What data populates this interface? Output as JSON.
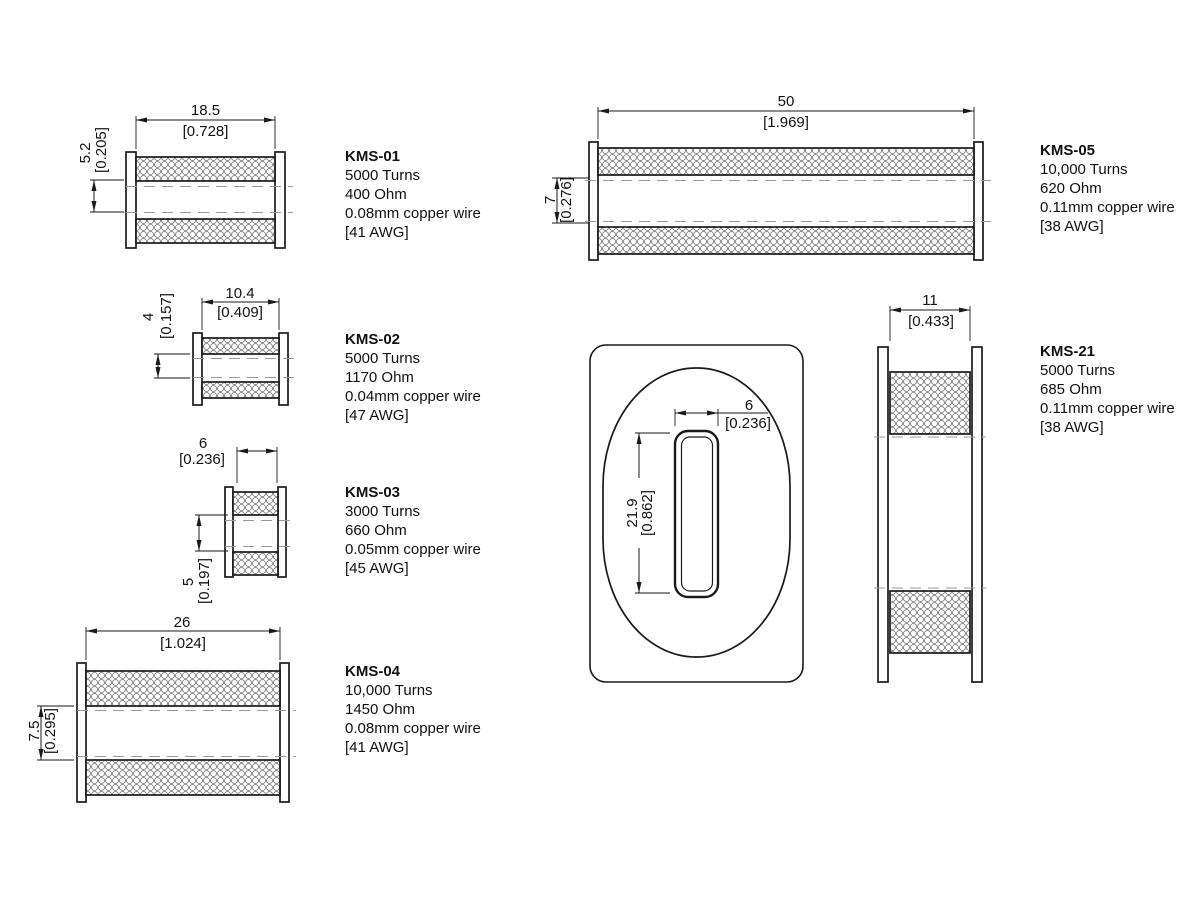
{
  "sheet": {
    "background": "#ffffff",
    "line_color": "#1a1a1a",
    "dashed_color": "#999999",
    "hatch_name": "coil-winding-hatch"
  },
  "products": [
    {
      "id": "KMS-01",
      "turns": "5000 Turns",
      "ohm": "400 Ohm",
      "wire": "0.08mm copper wire",
      "awg": "[41 AWG]",
      "width_mm": "18.5",
      "width_in": "[0.728]",
      "height_mm": "5.2",
      "height_in": "[0.205]"
    },
    {
      "id": "KMS-02",
      "turns": "5000 Turns",
      "ohm": "1170 Ohm",
      "wire": "0.04mm copper wire",
      "awg": "[47 AWG]",
      "width_mm": "10.4",
      "width_in": "[0.409]",
      "height_mm": "4",
      "height_in": "[0.157]"
    },
    {
      "id": "KMS-03",
      "turns": "3000 Turns",
      "ohm": "660 Ohm",
      "wire": "0.05mm copper wire",
      "awg": "[45 AWG]",
      "width_mm": "6",
      "width_in": "[0.236]",
      "height_mm": "5",
      "height_in": "[0.197]"
    },
    {
      "id": "KMS-04",
      "turns": "10,000 Turns",
      "ohm": "1450 Ohm",
      "wire": "0.08mm copper wire",
      "awg": "[41 AWG]",
      "width_mm": "26",
      "width_in": "[1.024]",
      "height_mm": "7.5",
      "height_in": "[0.295]"
    },
    {
      "id": "KMS-05",
      "turns": "10,000 Turns",
      "ohm": "620 Ohm",
      "wire": "0.11mm copper wire",
      "awg": "[38 AWG]",
      "width_mm": "50",
      "width_in": "[1.969]",
      "height_mm": "7",
      "height_in": "[0.276]"
    },
    {
      "id": "KMS-21",
      "turns": "5000 Turns",
      "ohm": "685 Ohm",
      "wire": "0.11mm copper wire",
      "awg": "[38 AWG]",
      "width_mm": "11",
      "width_in": "[0.433]"
    }
  ],
  "front_view": {
    "slot_width_mm": "6",
    "slot_width_in": "[0.236]",
    "slot_height_mm": "21.9",
    "slot_height_in": "[0.862]"
  }
}
